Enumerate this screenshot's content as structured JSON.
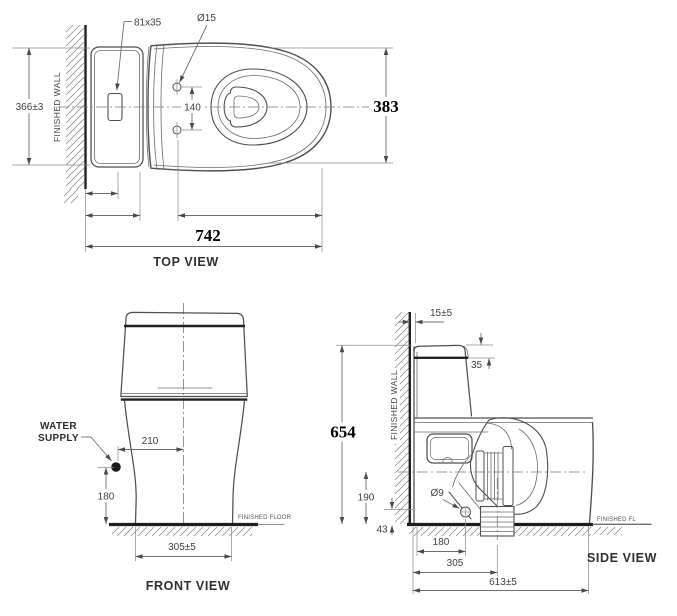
{
  "views": {
    "top": {
      "title": "TOP VIEW",
      "finished_wall": "FINISHED WALL",
      "dims": {
        "button_size": "81x35",
        "hole_diameter": "Ø15",
        "wall_to_edge": "366±3",
        "hole_spacing": "140",
        "bowl_width": "383",
        "overall_length": "742"
      }
    },
    "front": {
      "title": "FRONT VIEW",
      "water_supply_line1": "WATER",
      "water_supply_line2": "SUPPLY",
      "finished_floor": "FINISHED FLOOR",
      "dims": {
        "supply_to_center": "210",
        "supply_height": "180",
        "base_width": "305±5"
      }
    },
    "side": {
      "title": "SIDE VIEW",
      "finished_wall": "FINISHED WALL",
      "finished_floor": "FINISHED FL",
      "dims": {
        "wall_gap": "15±5",
        "tank_lid": "35",
        "overall_height": "654",
        "trap_height": "190",
        "bolt_hole": "Ø9",
        "base_lip": "43",
        "bolt_from_wall": "180",
        "outlet_from_wall": "305",
        "overall_depth": "613±5"
      }
    }
  }
}
